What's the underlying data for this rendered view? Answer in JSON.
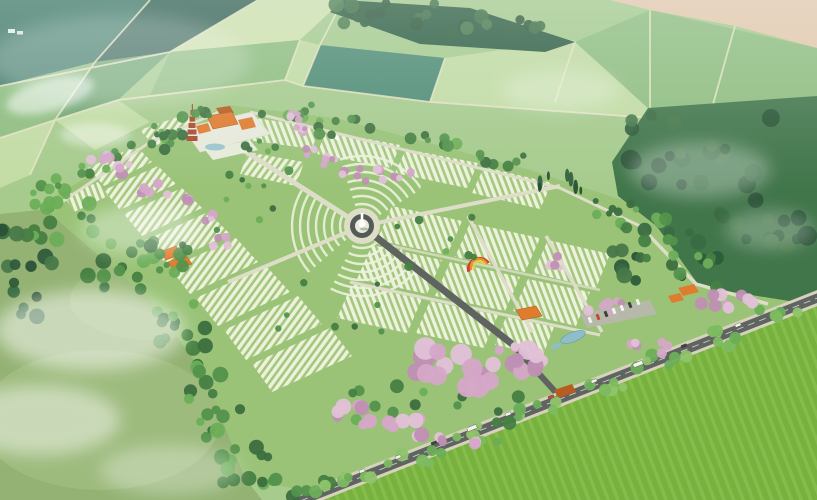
{
  "scene": {
    "subject": "aerial architectural rendering of a landscaped memorial park with temple complex, pagoda tower, central monument roundabout, terraced burial plot rows, pink blossom tree avenues, entrance road with vehicles, surrounded by patchwork farmland and forest"
  },
  "palette": {
    "farmland_base": "#a7cb8d",
    "field_light": "#c3dca4",
    "field_pale": "#d2e2ae",
    "field_mid": "#8fbd7f",
    "field_dark": "#6fa571",
    "field_teal": "#3f7767",
    "field_teal_dark": "#335f52",
    "field_bluegreen": "#4d8a74",
    "field_path": "#e9e4c6",
    "bare_field_tan": "#e8c9ae",
    "forest_top": "#2b5a40",
    "forest_right": "#41754a",
    "lawn": "#9ac378",
    "meadow": "#93b273",
    "meadow_light": "#a8c286",
    "bright_field": "#77b13e",
    "bright_field_light": "#8fc557",
    "plot_light": "#edf2dc",
    "plot_green": "#a4c77e",
    "road_dark": "#5f6461",
    "road_mid": "#787d76",
    "path_pale": "#ddddc8",
    "sidewalk": "#d6d2bc",
    "lane_dash": "#eceee6",
    "plaza_white": "#e8eadd",
    "plaza_step": "#eef0e4",
    "roundabout_ring": "#555a56",
    "monument_white": "#ffffff",
    "monument_shadow": "#7d8a6f",
    "blossom": "#d5a6c8",
    "blossom_dark": "#c08fb4",
    "blossom_light": "#e2c1d8",
    "roof_orange": "#e07c2e",
    "roof_orange_dark": "#b85c1f",
    "pagoda_red": "#aa4a2e",
    "pagoda_edge": "#7e2f1c",
    "water": "#8fbecb",
    "water_edge": "#6899a8",
    "parking_gray": "#b6b9aa",
    "car_white": "#f2f4f0",
    "car_dark": "#3d4145",
    "car_red": "#c04a3a",
    "rainbow_red": "#d23b2f",
    "rainbow_orange": "#e8912c",
    "rainbow_yellow": "#e8d13f",
    "farmhouse_white": "#f4f4ee",
    "farmhouse_gray": "#e8e8e2",
    "mist": "#ffffff",
    "haze_tint": "#e1f0eb"
  },
  "tree_palettes": {
    "greens": [
      "#3c6f3f",
      "#53924c",
      "#6cae58",
      "#467f42"
    ],
    "bright": [
      "#6cae58",
      "#7dbb60",
      "#8fc46b"
    ],
    "forest": [
      "#2e5c3a",
      "#3a6b42",
      "#48784a",
      "#2a5236"
    ],
    "pinks": [
      "#d5a6c8",
      "#c08fb4",
      "#e2c1d8"
    ],
    "conifer": [
      "#274f33",
      "#335f3d"
    ]
  },
  "tree_clusters": [
    {
      "x": 395,
      "y": 14,
      "w": 120,
      "h": 22,
      "n": 16,
      "r": [
        4,
        8
      ],
      "p": "forest"
    },
    {
      "x": 492,
      "y": 26,
      "w": 100,
      "h": 20,
      "n": 12,
      "r": [
        4,
        8
      ],
      "p": "forest"
    },
    {
      "x": 700,
      "y": 150,
      "w": 170,
      "h": 70,
      "n": 20,
      "r": [
        5,
        10
      ],
      "p": "forest"
    },
    {
      "x": 735,
      "y": 225,
      "w": 150,
      "h": 70,
      "n": 18,
      "r": [
        5,
        10
      ],
      "p": "forest"
    },
    {
      "x": 650,
      "y": 255,
      "w": 90,
      "h": 60,
      "n": 12,
      "r": [
        4,
        8
      ],
      "p": "forest"
    },
    {
      "x": 60,
      "y": 220,
      "w": 70,
      "h": 45,
      "n": 14,
      "r": [
        4,
        8
      ],
      "p": "greens"
    },
    {
      "x": 120,
      "y": 270,
      "w": 70,
      "h": 55,
      "n": 15,
      "r": [
        4,
        8
      ],
      "p": "greens"
    },
    {
      "x": 178,
      "y": 335,
      "w": 60,
      "h": 65,
      "n": 15,
      "r": [
        4,
        8
      ],
      "p": "greens"
    },
    {
      "x": 215,
      "y": 405,
      "w": 55,
      "h": 70,
      "n": 14,
      "r": [
        4,
        8
      ],
      "p": "greens"
    },
    {
      "x": 245,
      "y": 465,
      "w": 70,
      "h": 40,
      "n": 12,
      "r": [
        4,
        8
      ],
      "p": "greens"
    },
    {
      "x": 300,
      "y": 487,
      "w": 70,
      "h": 22,
      "n": 8,
      "r": [
        4,
        7
      ],
      "p": "greens"
    },
    {
      "x": 52,
      "y": 192,
      "w": 46,
      "h": 28,
      "n": 8,
      "r": [
        3,
        7
      ],
      "p": "greens"
    },
    {
      "x": 100,
      "y": 162,
      "w": 40,
      "h": 24,
      "n": 7,
      "r": [
        3,
        6
      ],
      "p": "greens"
    },
    {
      "x": 152,
      "y": 136,
      "w": 46,
      "h": 22,
      "n": 7,
      "r": [
        3,
        6
      ],
      "p": "greens"
    },
    {
      "x": 200,
      "y": 117,
      "w": 36,
      "h": 18,
      "n": 5,
      "r": [
        3,
        6
      ],
      "p": "greens"
    },
    {
      "x": 285,
      "y": 112,
      "w": 56,
      "h": 16,
      "n": 7,
      "r": [
        3,
        6
      ],
      "p": "greens"
    },
    {
      "x": 350,
      "y": 126,
      "w": 64,
      "h": 18,
      "n": 8,
      "r": [
        3,
        6
      ],
      "p": "greens"
    },
    {
      "x": 425,
      "y": 143,
      "w": 70,
      "h": 18,
      "n": 8,
      "r": [
        3,
        6
      ],
      "p": "greens"
    },
    {
      "x": 500,
      "y": 163,
      "w": 64,
      "h": 18,
      "n": 7,
      "r": [
        3,
        6
      ],
      "p": "greens"
    },
    {
      "x": 565,
      "y": 182,
      "w": 56,
      "h": 18,
      "n": 7,
      "r": [
        3,
        6
      ],
      "p": "conifer"
    },
    {
      "x": 615,
      "y": 205,
      "w": 50,
      "h": 20,
      "n": 7,
      "r": [
        3,
        6
      ],
      "p": "greens"
    },
    {
      "x": 648,
      "y": 238,
      "w": 56,
      "h": 44,
      "n": 10,
      "r": [
        4,
        7
      ],
      "p": "greens"
    },
    {
      "x": 696,
      "y": 272,
      "w": 48,
      "h": 36,
      "n": 8,
      "r": [
        4,
        7
      ],
      "p": "greens"
    },
    {
      "x": 168,
      "y": 256,
      "w": 52,
      "h": 36,
      "n": 10,
      "r": [
        3,
        7
      ],
      "p": "greens"
    },
    {
      "x": 250,
      "y": 205,
      "w": 110,
      "h": 70,
      "n": 9,
      "r": [
        2.5,
        4.5
      ],
      "p": "greens"
    },
    {
      "x": 430,
      "y": 245,
      "w": 120,
      "h": 60,
      "n": 8,
      "r": [
        2.5,
        4.5
      ],
      "p": "greens"
    },
    {
      "x": 330,
      "y": 310,
      "w": 110,
      "h": 55,
      "n": 8,
      "r": [
        2.5,
        4.5
      ],
      "p": "greens"
    },
    {
      "x": 262,
      "y": 142,
      "w": 40,
      "h": 20,
      "n": 5,
      "r": [
        2.5,
        5
      ],
      "p": "greens"
    },
    {
      "x": 352,
      "y": 482,
      "w": 54,
      "h": 16,
      "n": 6,
      "r": [
        4,
        7
      ],
      "p": "bright"
    },
    {
      "x": 415,
      "y": 458,
      "w": 54,
      "h": 16,
      "n": 6,
      "r": [
        4,
        7
      ],
      "p": "bright"
    },
    {
      "x": 478,
      "y": 434,
      "w": 54,
      "h": 16,
      "n": 6,
      "r": [
        4,
        7
      ],
      "p": "bright"
    },
    {
      "x": 540,
      "y": 410,
      "w": 54,
      "h": 16,
      "n": 6,
      "r": [
        4,
        7
      ],
      "p": "bright"
    },
    {
      "x": 602,
      "y": 386,
      "w": 54,
      "h": 16,
      "n": 6,
      "r": [
        4,
        7
      ],
      "p": "bright"
    },
    {
      "x": 664,
      "y": 362,
      "w": 54,
      "h": 16,
      "n": 6,
      "r": [
        4,
        7
      ],
      "p": "bright"
    },
    {
      "x": 726,
      "y": 338,
      "w": 54,
      "h": 16,
      "n": 6,
      "r": [
        4,
        7
      ],
      "p": "bright"
    },
    {
      "x": 780,
      "y": 317,
      "w": 44,
      "h": 14,
      "n": 5,
      "r": [
        4,
        7
      ],
      "p": "bright"
    },
    {
      "x": 380,
      "y": 400,
      "w": 90,
      "h": 40,
      "n": 8,
      "r": [
        4,
        7
      ],
      "p": "greens"
    },
    {
      "x": 480,
      "y": 408,
      "w": 80,
      "h": 30,
      "n": 7,
      "r": [
        4,
        7
      ],
      "p": "greens"
    },
    {
      "x": 172,
      "y": 138,
      "w": 30,
      "h": 24,
      "n": 6,
      "r": [
        3,
        6
      ],
      "p": "greens"
    },
    {
      "x": 30,
      "y": 250,
      "w": 60,
      "h": 40,
      "n": 8,
      "r": [
        4,
        8
      ],
      "p": "forest"
    },
    {
      "x": 15,
      "y": 300,
      "w": 50,
      "h": 40,
      "n": 7,
      "r": [
        4,
        8
      ],
      "p": "forest"
    },
    {
      "x": 102,
      "y": 152,
      "w": 22,
      "h": 16,
      "n": 5,
      "r": [
        3,
        5.5
      ],
      "p": "pinks"
    },
    {
      "x": 122,
      "y": 168,
      "w": 22,
      "h": 16,
      "n": 5,
      "r": [
        3,
        5.5
      ],
      "p": "pinks"
    },
    {
      "x": 148,
      "y": 186,
      "w": 26,
      "h": 16,
      "n": 5,
      "r": [
        3,
        5.5
      ],
      "p": "pinks"
    },
    {
      "x": 178,
      "y": 202,
      "w": 26,
      "h": 16,
      "n": 5,
      "r": [
        3,
        5.5
      ],
      "p": "pinks"
    },
    {
      "x": 204,
      "y": 218,
      "w": 22,
      "h": 16,
      "n": 4,
      "r": [
        3,
        5.5
      ],
      "p": "pinks"
    },
    {
      "x": 220,
      "y": 238,
      "w": 18,
      "h": 18,
      "n": 4,
      "r": [
        3,
        5.5
      ],
      "p": "pinks"
    },
    {
      "x": 292,
      "y": 118,
      "w": 16,
      "h": 12,
      "n": 4,
      "r": [
        2.5,
        5
      ],
      "p": "pinks"
    },
    {
      "x": 302,
      "y": 132,
      "w": 16,
      "h": 14,
      "n": 4,
      "r": [
        2.5,
        5
      ],
      "p": "pinks"
    },
    {
      "x": 315,
      "y": 148,
      "w": 18,
      "h": 14,
      "n": 4,
      "r": [
        2.5,
        5
      ],
      "p": "pinks"
    },
    {
      "x": 330,
      "y": 161,
      "w": 20,
      "h": 14,
      "n": 5,
      "r": [
        2.5,
        5
      ],
      "p": "pinks"
    },
    {
      "x": 352,
      "y": 170,
      "w": 24,
      "h": 12,
      "n": 5,
      "r": [
        2.5,
        5
      ],
      "p": "pinks"
    },
    {
      "x": 377,
      "y": 175,
      "w": 24,
      "h": 12,
      "n": 5,
      "r": [
        2.5,
        5
      ],
      "p": "pinks"
    },
    {
      "x": 400,
      "y": 177,
      "w": 22,
      "h": 12,
      "n": 4,
      "r": [
        2.5,
        5
      ],
      "p": "pinks"
    },
    {
      "x": 556,
      "y": 262,
      "w": 30,
      "h": 14,
      "n": 5,
      "r": [
        3,
        5
      ],
      "p": "pinks"
    },
    {
      "x": 604,
      "y": 306,
      "w": 44,
      "h": 16,
      "n": 6,
      "r": [
        3,
        6
      ],
      "p": "pinks"
    },
    {
      "x": 648,
      "y": 348,
      "w": 40,
      "h": 16,
      "n": 6,
      "r": [
        3,
        6
      ],
      "p": "pinks"
    },
    {
      "x": 726,
      "y": 295,
      "w": 56,
      "h": 28,
      "n": 9,
      "r": [
        4,
        7
      ],
      "p": "pinks"
    },
    {
      "x": 435,
      "y": 362,
      "w": 64,
      "h": 30,
      "n": 8,
      "r": [
        7,
        12
      ],
      "p": "pinks"
    },
    {
      "x": 492,
      "y": 376,
      "w": 66,
      "h": 28,
      "n": 8,
      "r": [
        7,
        12
      ],
      "p": "pinks"
    },
    {
      "x": 535,
      "y": 360,
      "w": 44,
      "h": 22,
      "n": 6,
      "r": [
        6,
        10
      ],
      "p": "pinks"
    },
    {
      "x": 352,
      "y": 416,
      "w": 52,
      "h": 22,
      "n": 7,
      "r": [
        5,
        8
      ],
      "p": "pinks"
    },
    {
      "x": 408,
      "y": 428,
      "w": 52,
      "h": 20,
      "n": 7,
      "r": [
        5,
        8
      ],
      "p": "pinks"
    },
    {
      "x": 458,
      "y": 440,
      "w": 40,
      "h": 16,
      "n": 5,
      "r": [
        4,
        7
      ],
      "p": "pinks"
    },
    {
      "x": 512,
      "y": 352,
      "w": 26,
      "h": 14,
      "n": 4,
      "r": [
        4,
        6
      ],
      "p": "pinks"
    }
  ],
  "vehicles": [
    {
      "x": 362,
      "y": 471,
      "c": "car_white",
      "type": "car"
    },
    {
      "x": 398,
      "y": 457,
      "c": "car_white",
      "type": "car"
    },
    {
      "x": 434,
      "y": 443,
      "c": "car_dark",
      "type": "car"
    },
    {
      "x": 472,
      "y": 428,
      "c": "car_white",
      "type": "bus"
    },
    {
      "x": 508,
      "y": 414,
      "c": "car_white",
      "type": "car"
    },
    {
      "x": 551,
      "y": 397,
      "c": "car_red",
      "type": "car"
    },
    {
      "x": 594,
      "y": 381,
      "c": "car_white",
      "type": "car"
    },
    {
      "x": 638,
      "y": 364,
      "c": "car_white",
      "type": "bus"
    },
    {
      "x": 684,
      "y": 346,
      "c": "car_dark",
      "type": "car"
    },
    {
      "x": 738,
      "y": 325,
      "c": "car_white",
      "type": "car"
    }
  ],
  "parking_cars": [
    {
      "x": 590,
      "y": 320,
      "c": "car_white"
    },
    {
      "x": 598,
      "y": 317,
      "c": "car_red"
    },
    {
      "x": 606,
      "y": 314,
      "c": "car_dark"
    },
    {
      "x": 614,
      "y": 311,
      "c": "car_white"
    },
    {
      "x": 622,
      "y": 308,
      "c": "car_white"
    },
    {
      "x": 630,
      "y": 305,
      "c": "car_dark"
    },
    {
      "x": 638,
      "y": 302,
      "c": "car_white"
    }
  ]
}
